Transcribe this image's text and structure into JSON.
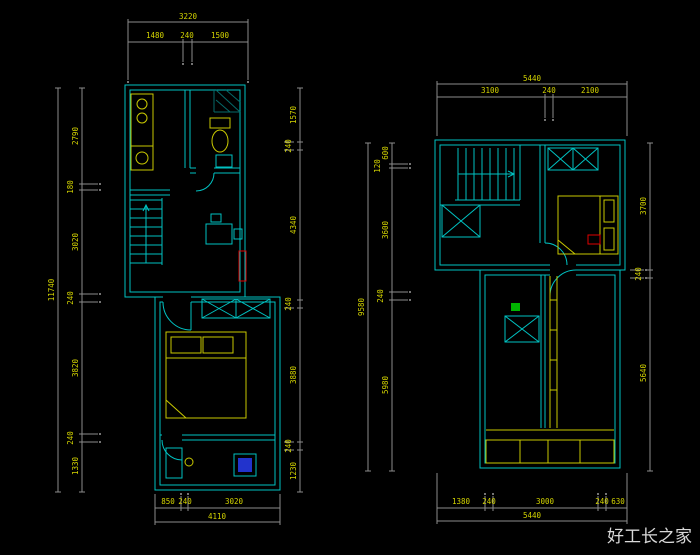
{
  "watermark": "好工长之家",
  "colors": {
    "background": "#000000",
    "wall": "#00c2c2",
    "fixture": "#c9c900",
    "dimension_text": "#d4d400",
    "dimension_line": "#8c8c8c",
    "accent_red": "#e00000",
    "accent_green": "#00b400",
    "accent_blue": "#2233cc"
  },
  "left_plan": {
    "top": {
      "total": "3220",
      "segments": [
        "1480",
        "240",
        "1500"
      ]
    },
    "left": {
      "overall": "11740",
      "segments": [
        "2790",
        "180",
        "3020",
        "240",
        "3820",
        "240",
        "1330"
      ]
    },
    "right": {
      "segments": [
        "1570",
        "240",
        "4340",
        "240",
        "3880",
        "240",
        "1230"
      ]
    },
    "bottom": {
      "total": "4110",
      "segments": [
        "850",
        "240",
        "3020"
      ]
    }
  },
  "right_plan": {
    "top": {
      "total": "5440",
      "segments": [
        "3100",
        "240",
        "2100"
      ]
    },
    "left": {
      "overall": "9580",
      "segments": [
        "600",
        "120",
        "3600",
        "240",
        "5980"
      ]
    },
    "right": {
      "segments": [
        "3700",
        "240",
        "5640"
      ]
    },
    "bottom": {
      "total": "5440",
      "segments": [
        "1380",
        "240",
        "3000",
        "240",
        "630"
      ]
    }
  }
}
